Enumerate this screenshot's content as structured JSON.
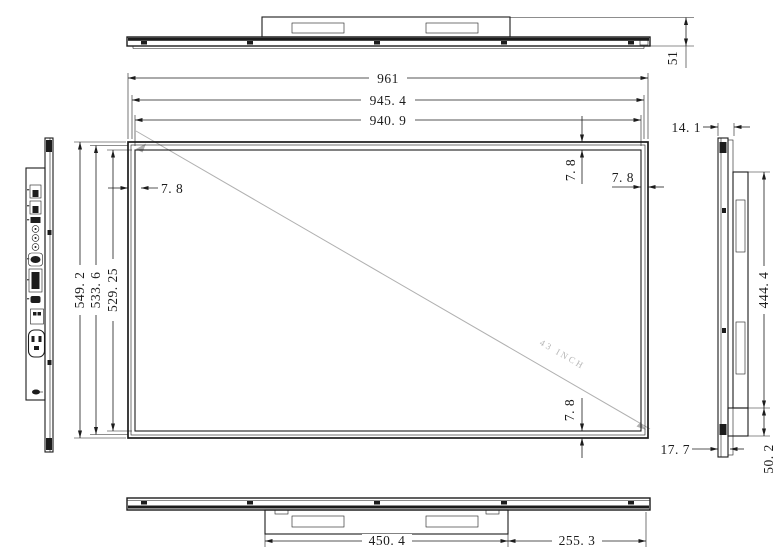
{
  "title": "43 inch display panel dimensional drawing",
  "views": {
    "top": {
      "depth": "51"
    },
    "front": {
      "width_outer": "961",
      "width_frame": "945. 4",
      "width_active": "940. 9",
      "height_outer": "549. 2",
      "height_frame": "533. 6",
      "height_active": "529. 25",
      "bezel_left": "7. 8",
      "bezel_top": "7. 8",
      "bezel_right": "7. 8",
      "bezel_bottom": "7. 8",
      "diagonal_label": "43 INCH"
    },
    "side_right": {
      "panel_thickness": "14. 1",
      "back_box_height": "444. 4",
      "bottom_depth": "50. 2",
      "bottom_offset": "17. 7"
    },
    "bottom": {
      "box_width": "450. 4",
      "right_offset": "255. 3"
    }
  },
  "colors": {
    "line": "#1c1c1c",
    "diagonal_gray": "#b5b5b5",
    "background": "#ffffff"
  }
}
